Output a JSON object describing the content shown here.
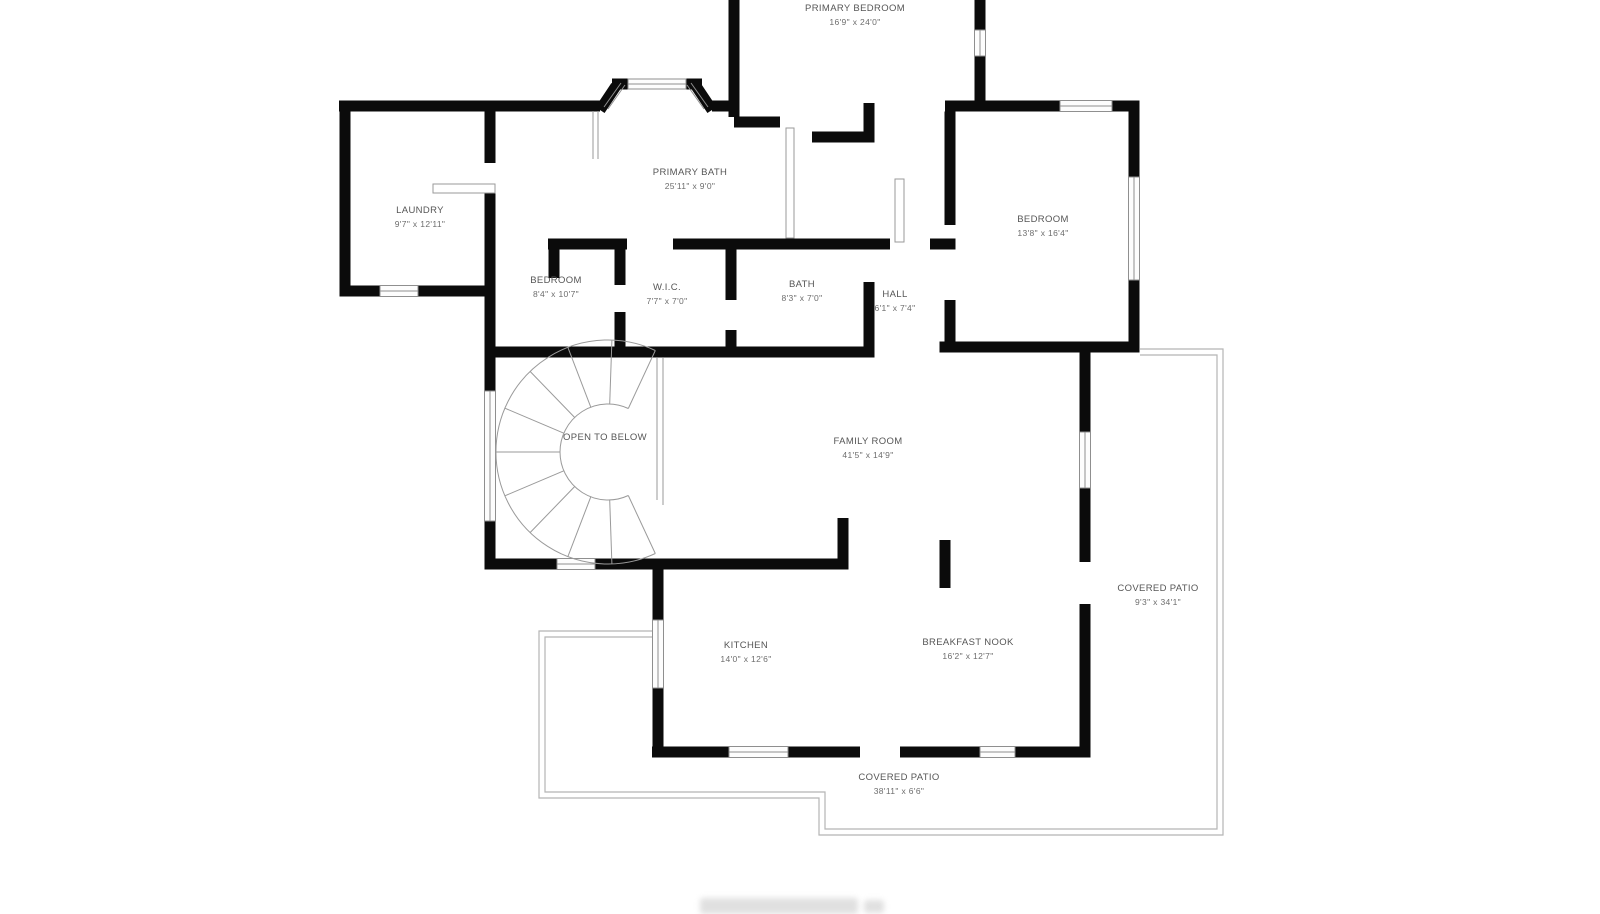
{
  "rooms": {
    "primary_bedroom": {
      "name": "PRIMARY BEDROOM",
      "dims": "16'9\" x 24'0\""
    },
    "laundry": {
      "name": "LAUNDRY",
      "dims": "9'7\" x 12'11\""
    },
    "primary_bath": {
      "name": "PRIMARY BATH",
      "dims": "25'11\" x 9'0\""
    },
    "bedroom_left": {
      "name": "BEDROOM",
      "dims": "8'4\" x 10'7\""
    },
    "wic": {
      "name": "W.I.C.",
      "dims": "7'7\" x 7'0\""
    },
    "bath": {
      "name": "BATH",
      "dims": "8'3\" x 7'0\""
    },
    "hall": {
      "name": "HALL",
      "dims": "6'1\" x 7'4\""
    },
    "bedroom_right": {
      "name": "BEDROOM",
      "dims": "13'8\" x 16'4\""
    },
    "open_to_below": {
      "name": "OPEN TO BELOW"
    },
    "family_room": {
      "name": "FAMILY ROOM",
      "dims": "41'5\" x 14'9\""
    },
    "covered_patio_right": {
      "name": "COVERED PATIO",
      "dims": "9'3\" x 34'1\""
    },
    "kitchen": {
      "name": "KITCHEN",
      "dims": "14'0\" x 12'6\""
    },
    "breakfast_nook": {
      "name": "BREAKFAST NOOK",
      "dims": "16'2\" x 12'7\""
    },
    "covered_patio_bottom": {
      "name": "COVERED PATIO",
      "dims": "38'11\" x 6'6\""
    }
  },
  "colors": {
    "wall": "#0b0b0b",
    "thin_line": "#9a9a9a",
    "patio_line": "#b5b5b5",
    "label_text": "#585858",
    "background": "#ffffff"
  }
}
